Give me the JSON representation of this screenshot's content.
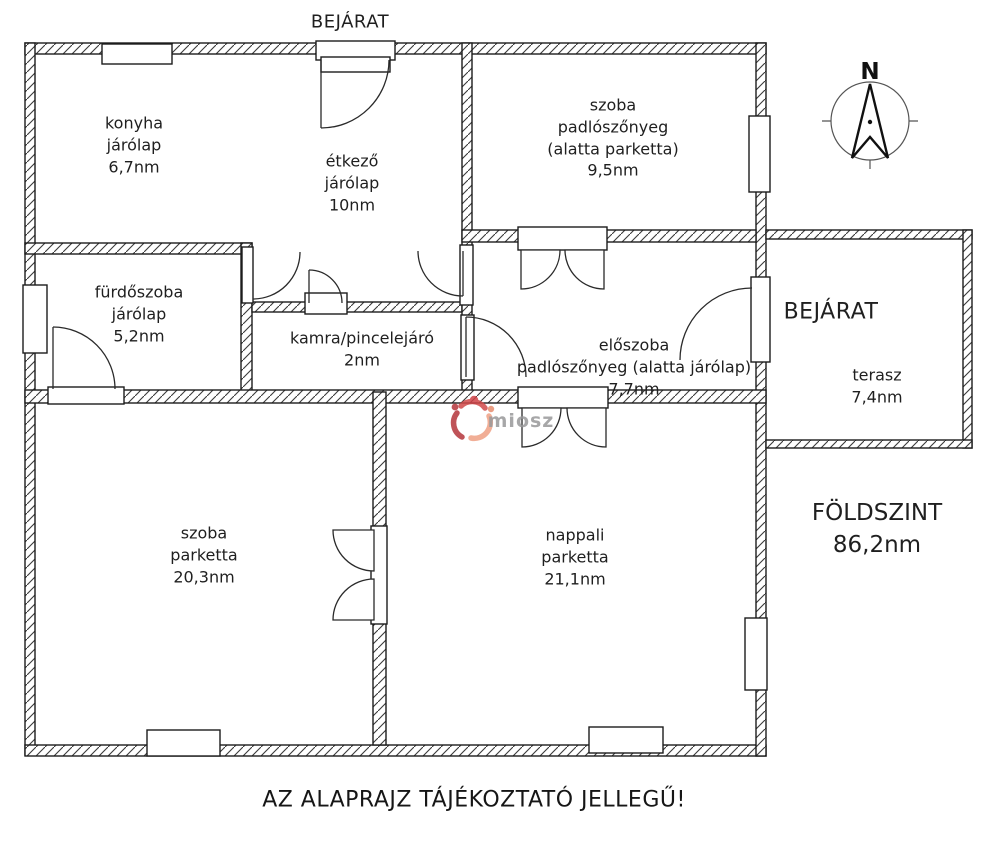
{
  "labels": {
    "entrance_top": "BEJÁRAT",
    "compass_north": "N",
    "entrance_terrace": "BEJÁRAT",
    "floor_title": "FÖLDSZINT",
    "floor_area": "86,2nm",
    "disclaimer": "AZ ALAPRAJZ TÁJÉKOZTATÓ JELLEGŰ!",
    "watermark": "miosz"
  },
  "rooms": {
    "konyha": {
      "name": "konyha",
      "floor": "járólap",
      "area": "6,7nm"
    },
    "etkezo": {
      "name": "étkező",
      "floor": "járólap",
      "area": "10nm"
    },
    "szoba_felso": {
      "name": "szoba",
      "floor": "padlószőnyeg",
      "floor_note": "(alatta parketta)",
      "area": "9,5nm"
    },
    "furdoszoba": {
      "name": "fürdőszoba",
      "floor": "járólap",
      "area": "5,2nm"
    },
    "kamra": {
      "name": "kamra/pincelejáró",
      "area": "2nm"
    },
    "eloszoba": {
      "name": "előszoba",
      "floor": "padlószőnyeg (alatta járólap)",
      "area": "7,7nm"
    },
    "terasz": {
      "name": "terasz",
      "area": "7,4nm"
    },
    "szoba_also": {
      "name": "szoba",
      "floor": "parketta",
      "area": "20,3nm"
    },
    "nappali": {
      "name": "nappali",
      "floor": "parketta",
      "area": "21,1nm"
    }
  },
  "colors": {
    "wall_line": "#1c1c1c",
    "watermark_red": "#c5393b",
    "watermark_salmon": "#efa184",
    "watermark_gray": "#98989a"
  }
}
